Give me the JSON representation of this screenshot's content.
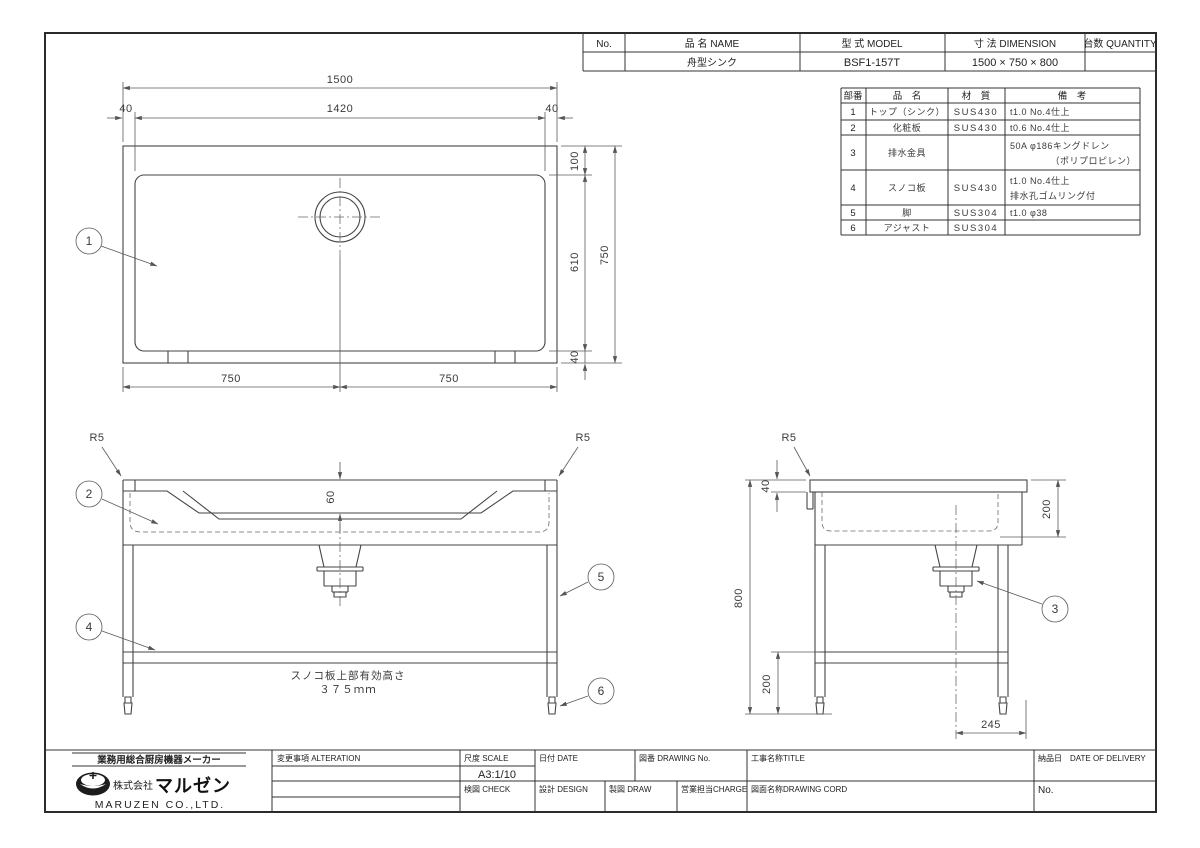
{
  "header_table": {
    "no_label": "No.",
    "name_label": "品 名  NAME",
    "model_label": "型 式  MODEL",
    "dimension_label": "寸 法  DIMENSION",
    "quantity_label": "台数 QUANTITY",
    "row": {
      "name": "舟型シンク",
      "model": "BSF1-157T",
      "dimension": "1500 ×  750 ×  800"
    }
  },
  "parts_table": {
    "col_num": "部番",
    "col_name": "品　名",
    "col_material": "材　質",
    "col_remarks": "備　考",
    "rows": [
      {
        "num": "1",
        "name": "トップ（シンク）",
        "material": "SUS430",
        "remarks1": "t1.0 No.4仕上",
        "remarks2": ""
      },
      {
        "num": "2",
        "name": "化粧板",
        "material": "SUS430",
        "remarks1": "t0.6 No.4仕上",
        "remarks2": ""
      },
      {
        "num": "3",
        "name": "排水金具",
        "material": "",
        "remarks1": "50A φ186キングドレン",
        "remarks2": "（ポリプロピレン）"
      },
      {
        "num": "4",
        "name": "スノコ板",
        "material": "SUS430",
        "remarks1": "t1.0 No.4仕上",
        "remarks2": "排水孔ゴムリング付"
      },
      {
        "num": "5",
        "name": "脚",
        "material": "SUS304",
        "remarks1": "t1.0 φ38",
        "remarks2": ""
      },
      {
        "num": "6",
        "name": "アジャスト",
        "material": "SUS304",
        "remarks1": "",
        "remarks2": ""
      }
    ]
  },
  "plan_view": {
    "dim_overall_width": "1500",
    "dim_inner_width": "1420",
    "dim_margin_left": "40",
    "dim_margin_right": "40",
    "dim_top": "100",
    "dim_mid": "610",
    "dim_bottom": "40",
    "dim_overall_depth": "750",
    "dim_half_left": "750",
    "dim_half_right": "750",
    "balloon_top": "1"
  },
  "front_view": {
    "radius_left": "R5",
    "radius_right": "R5",
    "dim_rim": "60",
    "balloon_bowl": "2",
    "balloon_shelf": "4",
    "balloon_leg": "5",
    "balloon_adjuster": "6",
    "note_line1": "スノコ板上部有効高さ",
    "note_line2": "３７５ｍｍ"
  },
  "side_view": {
    "radius": "R5",
    "dim_top_edge": "40",
    "dim_height": "800",
    "dim_bowl_depth": "200",
    "dim_shelf_height": "200",
    "dim_drain_offset": "245",
    "balloon_drain": "3"
  },
  "title_block": {
    "tagline": "業務用総合厨房機器メーカー",
    "company_prefix": "株式会社",
    "company_name": "マルゼン",
    "company_en": "MARUZEN CO.,LTD.",
    "alteration_label": "変更事項 ALTERATION",
    "scale_label": "尺度 SCALE",
    "scale_value": "A3:1/10",
    "date_label": "日付 DATE",
    "check_label": "検図 CHECK",
    "design_label": "設計 DESIGN",
    "draw_label": "製図 DRAW",
    "drawing_no_label": "図番 DRAWING No.",
    "charge_label": "営業担当CHARGE",
    "title_label": "工事名称TITLE",
    "drawing_cord_label": "図面名称DRAWING CORD",
    "delivery_label": "納品日　DATE OF DELIVERY",
    "no_label": "No."
  }
}
